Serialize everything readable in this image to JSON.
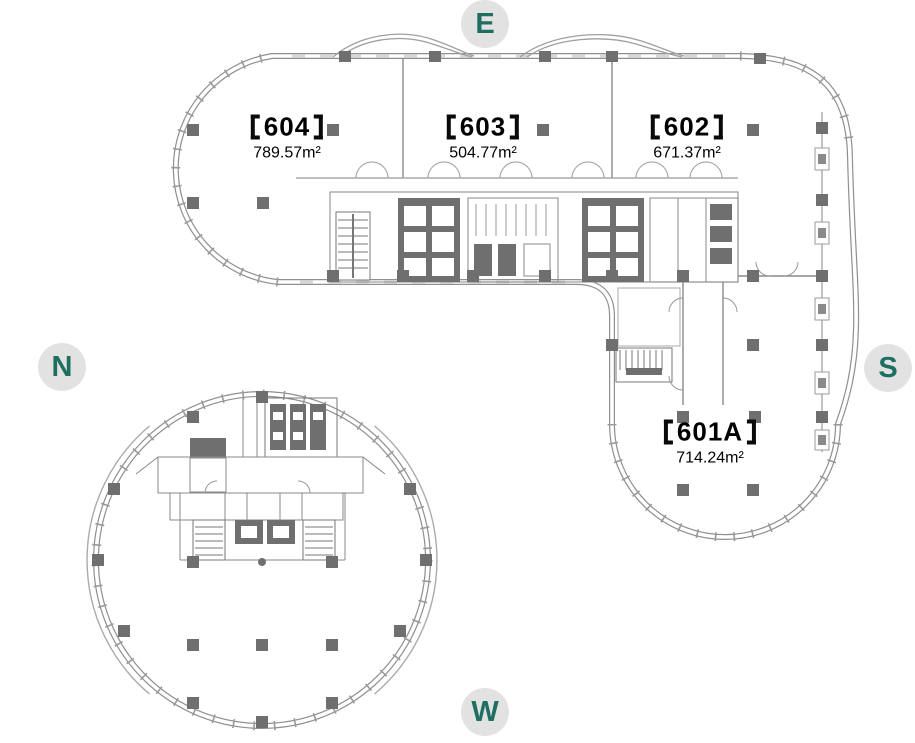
{
  "compass": {
    "east": "E",
    "north": "N",
    "south": "S",
    "west": "W"
  },
  "units": [
    {
      "number": "604",
      "label": "【604】",
      "area": "789.57m²"
    },
    {
      "number": "603",
      "label": "【603】",
      "area": "504.77m²"
    },
    {
      "number": "602",
      "label": "【602】",
      "area": "671.37m²"
    },
    {
      "number": "601A",
      "label": "【601A】",
      "area": "714.24m²"
    }
  ],
  "colors": {
    "accent_teal": "#1e6f62",
    "badge_bg": "#e2e2e2",
    "line_gray": "#8f8f8f",
    "column_gray": "#6f6f6f",
    "text_black": "#000000"
  }
}
